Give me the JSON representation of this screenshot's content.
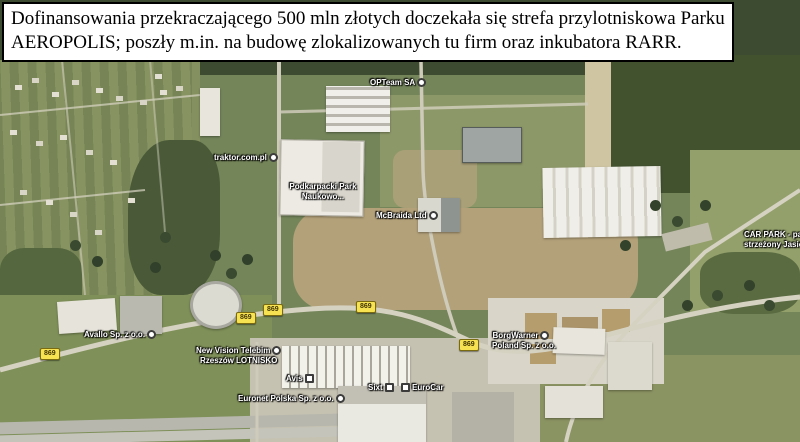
{
  "caption": {
    "line1": "Dofinansowania przekraczającego 500 mln złotych doczekała się strefa przylotniskowa Parku",
    "line2": "AEROPOLIS; poszły m.in. na budowę zlokalizowanych tu firm oraz inkubatora RARR."
  },
  "map": {
    "type": "satellite-aerial-view",
    "labels": [
      {
        "id": "opteam",
        "text": "OPTeam SA"
      },
      {
        "id": "traktor",
        "text": "traktor.com.pl"
      },
      {
        "id": "podkarpacki",
        "line1": "Podkarpacki Park",
        "line2": "Naukowo..."
      },
      {
        "id": "mcbraida",
        "text": "McBraida Ltd"
      },
      {
        "id": "carpark",
        "line1": "CAR PARK - parking",
        "line2": "strzeżony Jasionka"
      },
      {
        "id": "avallo",
        "text": "Avallo Sp. z o.o."
      },
      {
        "id": "newvision",
        "line1": "New Vision Telebim",
        "line2": "Rzeszów LOTNISKO"
      },
      {
        "id": "borgwarner",
        "line1": "BorgWarner",
        "line2": "Poland Sp. z o.o."
      },
      {
        "id": "avis",
        "text": "Avis"
      },
      {
        "id": "sixt",
        "text": "Sixt"
      },
      {
        "id": "eurocar",
        "text": "EuroCar"
      },
      {
        "id": "euronet",
        "text": "Euronet Polska Sp. z o.o."
      }
    ],
    "shields": [
      {
        "number": "869"
      },
      {
        "number": "869"
      },
      {
        "number": "869"
      },
      {
        "number": "869"
      },
      {
        "number": "869"
      }
    ]
  },
  "colors": {
    "shield_yellow": "#f7e352",
    "label_text": "#ffffff",
    "caption_bg": "#ffffff",
    "caption_border": "#000000",
    "field_green": "#74855a",
    "forest_green": "#3d4c31",
    "dirt_tan": "#b3a179"
  }
}
